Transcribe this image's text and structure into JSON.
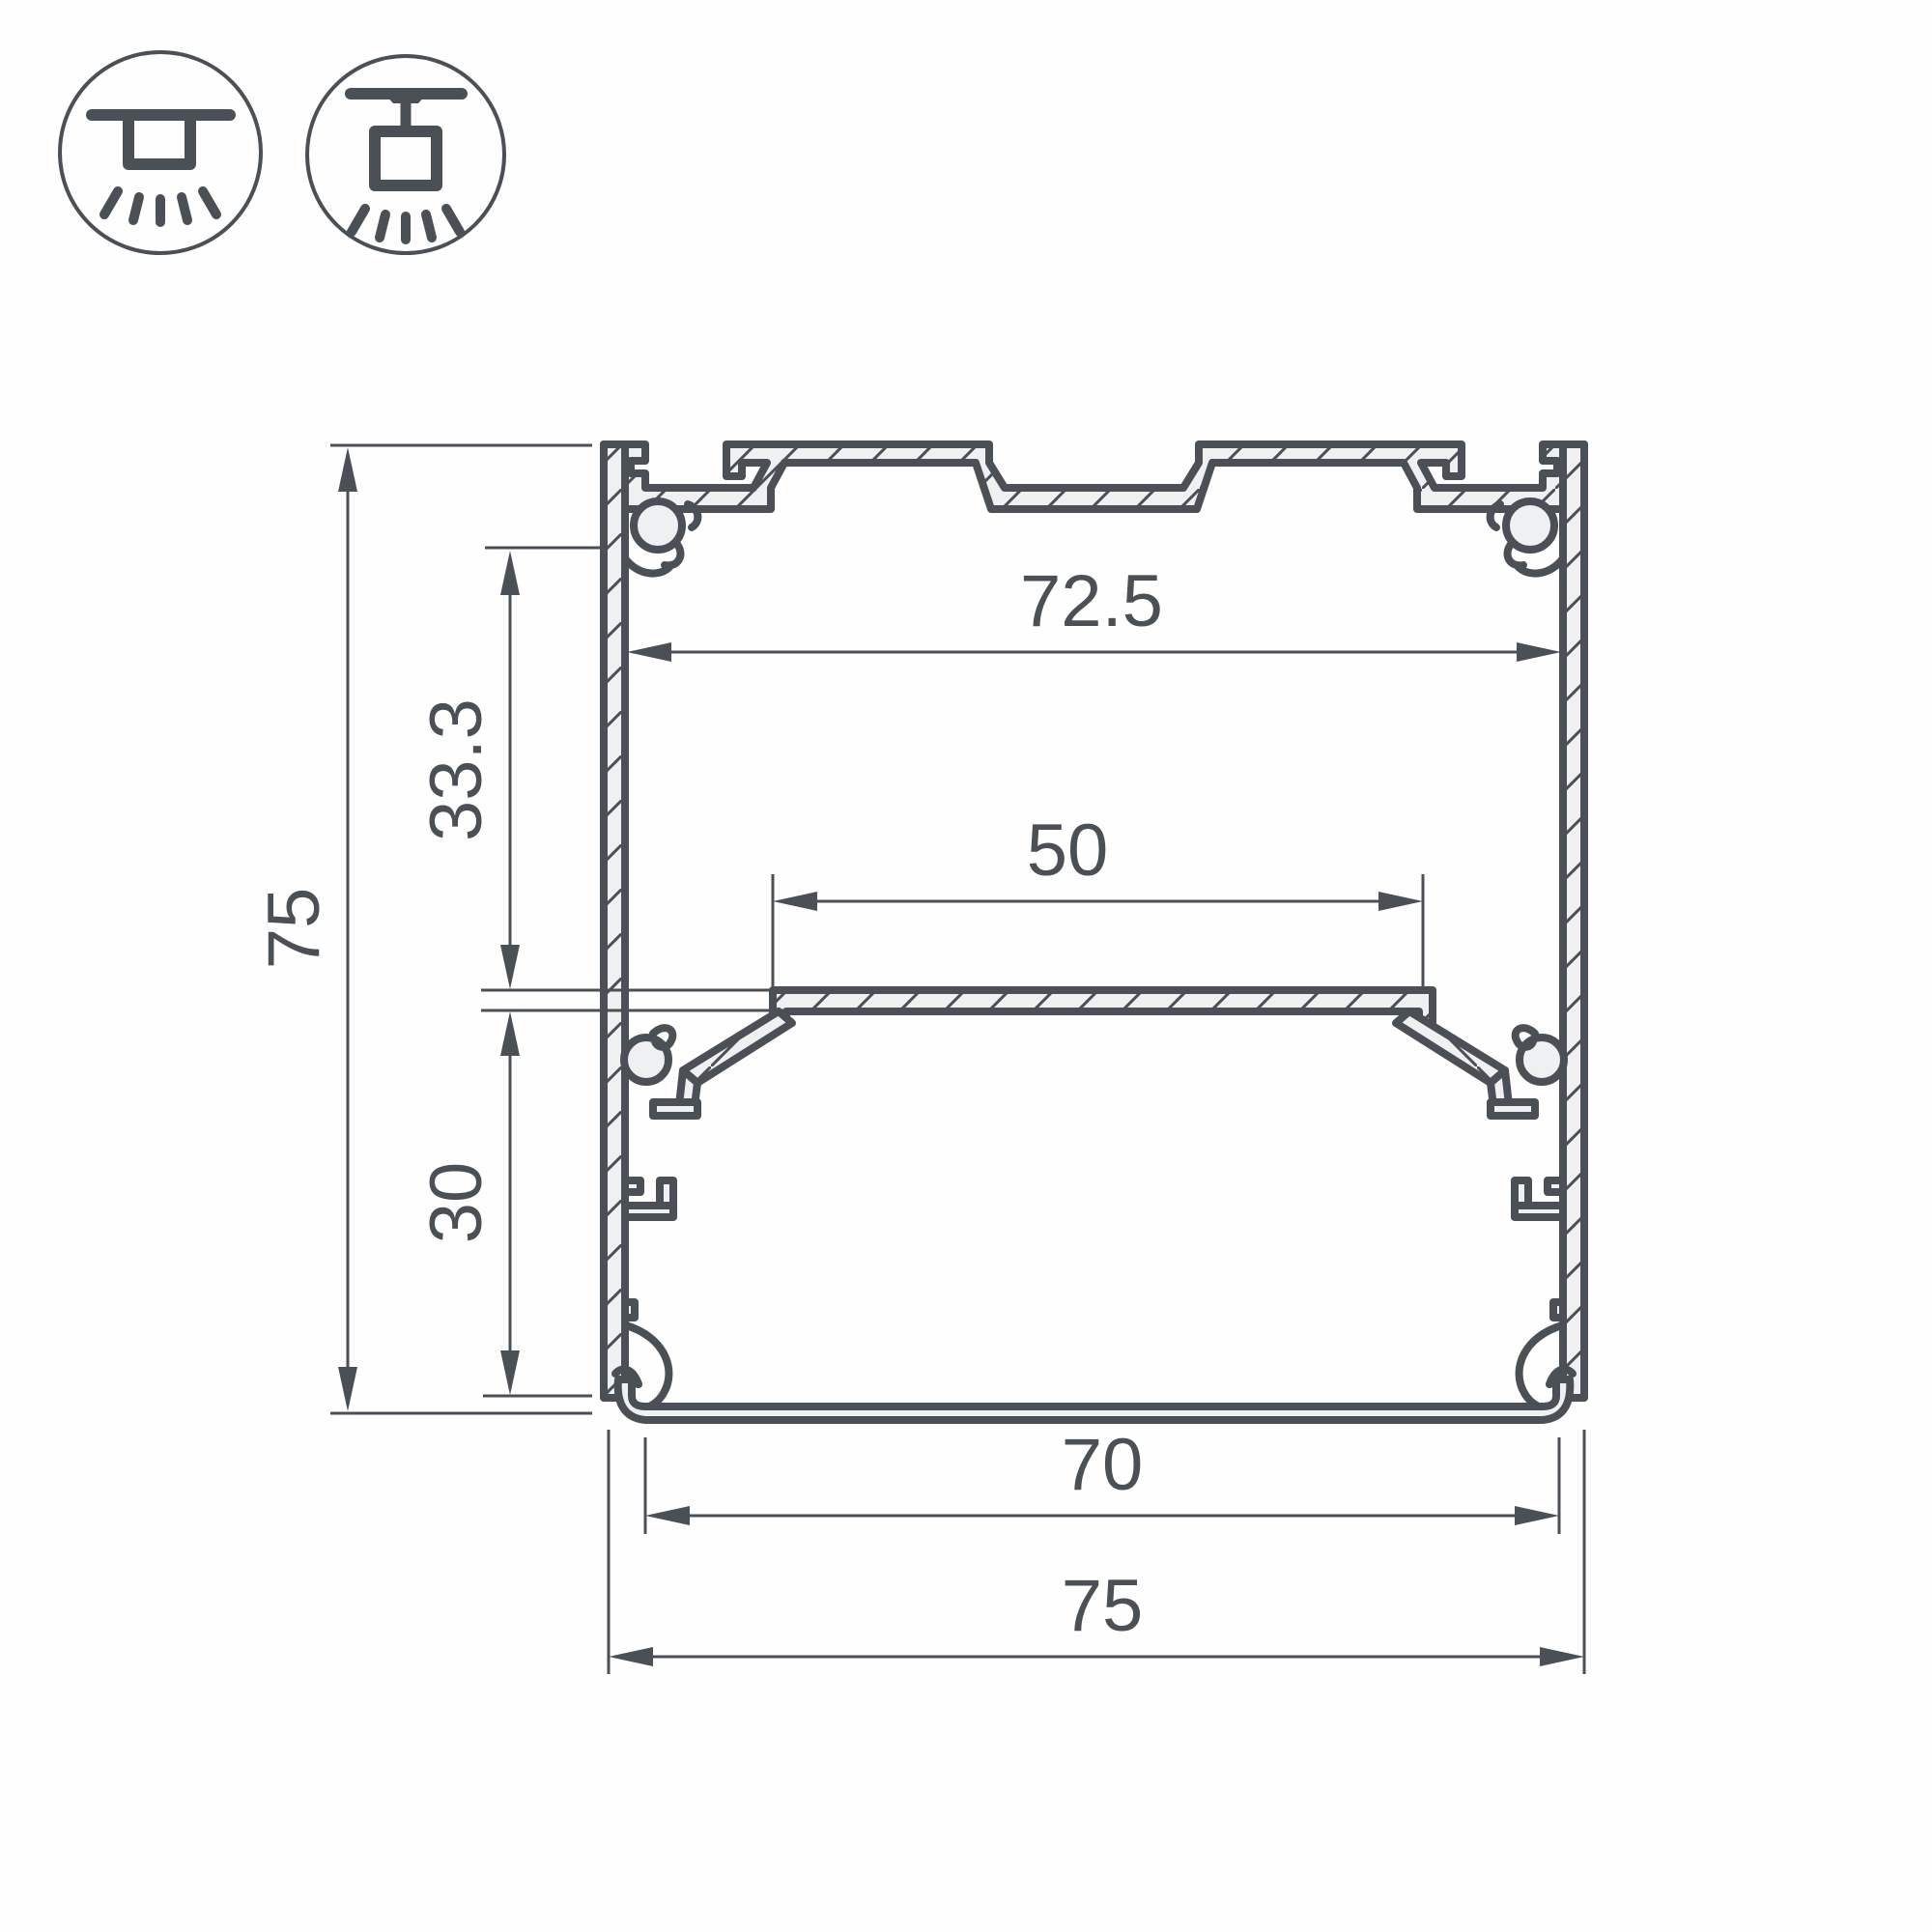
{
  "drawing": {
    "type": "aluminium-led-profile-cross-section",
    "colors": {
      "line": "#4a5055",
      "material_fill": "#eef0f1",
      "background": "#ffffff"
    }
  },
  "icons": {
    "surface_mount": "surface-mounted-luminaire",
    "pendant_mount": "suspended-luminaire"
  },
  "dimensions": {
    "overall_height": {
      "value": "75",
      "orientation": "vertical"
    },
    "inner_width": {
      "value": "72.5",
      "orientation": "horizontal"
    },
    "upper_depth": {
      "value": "33.3",
      "orientation": "vertical"
    },
    "shelf_width": {
      "value": "50",
      "orientation": "horizontal"
    },
    "lower_depth": {
      "value": "30",
      "orientation": "vertical"
    },
    "bottom_width": {
      "value": "70",
      "orientation": "horizontal"
    },
    "overall_width": {
      "value": "75",
      "orientation": "horizontal"
    }
  }
}
